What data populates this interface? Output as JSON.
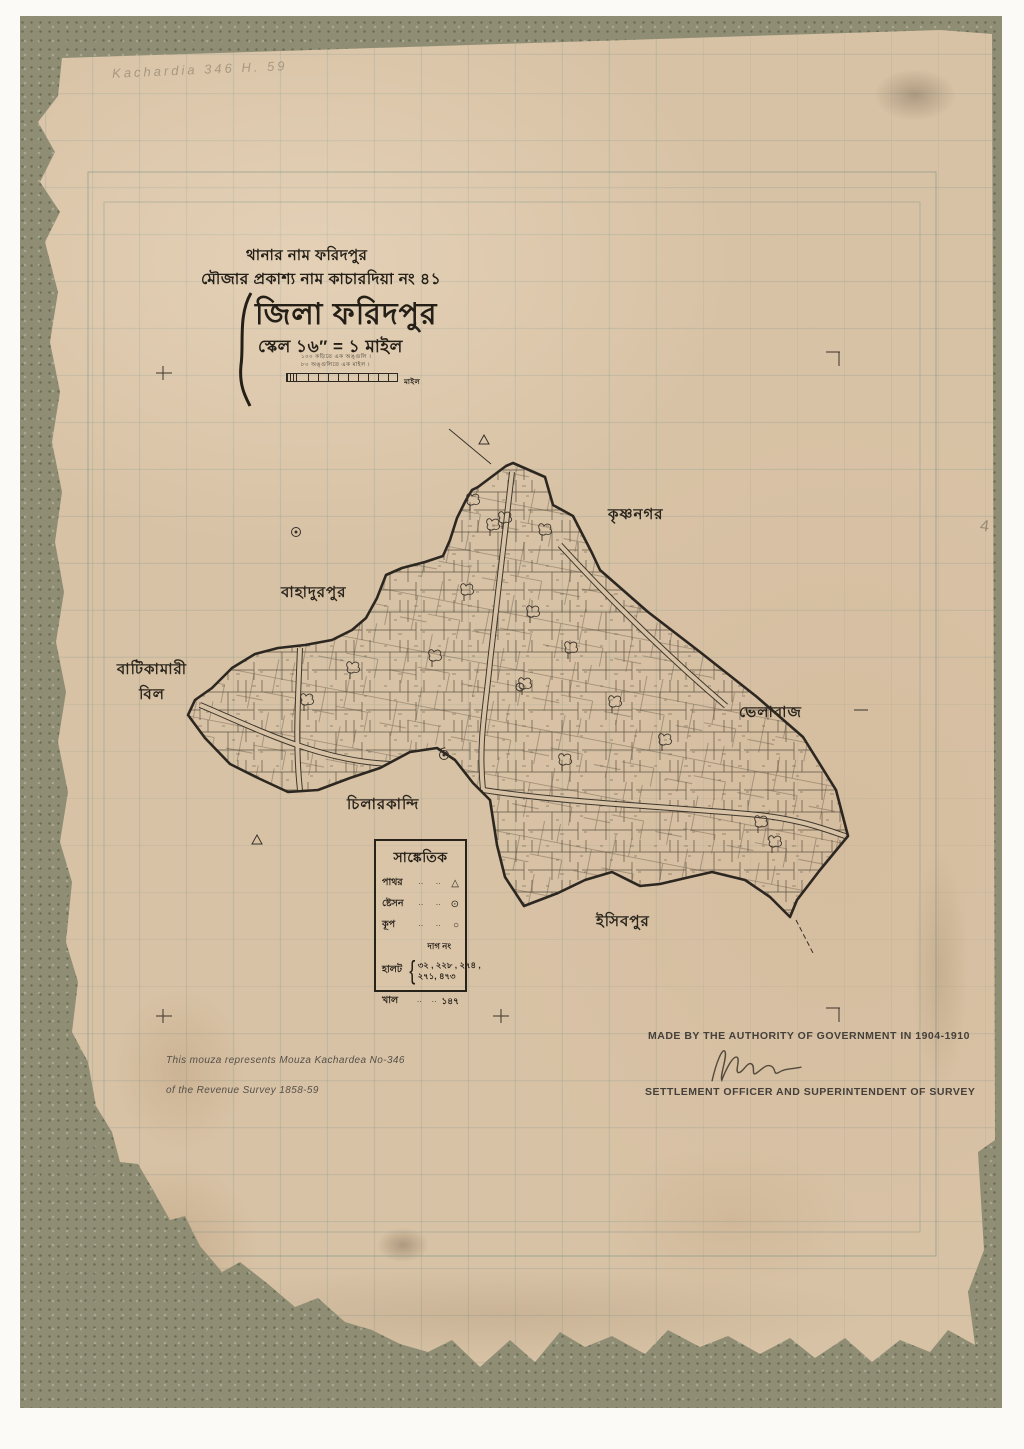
{
  "colors": {
    "paper": "#d8c2a5",
    "backing": "#8f8e75",
    "ink": "#241f17",
    "grid_line": "#688a84",
    "pencil": "#6f665a"
  },
  "title_block": {
    "thana_line": "থানার নাম ফরিদপুর",
    "mouza_line": "মৌজার প্রকাশ্য নাম কাচারদিয়া নং ৪১",
    "district_line": "জিলা ফরিদপুর",
    "scale_line": "স্কেল ১৬″ = ১ মাইল",
    "scale_note_1": "১০০ কড়িতে এক অঙ্গুলি ।",
    "scale_note_2": "৮০ অঙ্গুলিতে এক মাইল ।",
    "scale_unit_label": "মাইল"
  },
  "place_labels": {
    "krishnanagar": "কৃষ্ণনগর",
    "bahadurpur": "বাহাদুরপুর",
    "batikamari_bil": "বাটিকামারী\nবিল",
    "bhelabaj": "ভেলাবাজ",
    "chilarkandi": "চিলারকান্দি",
    "isibpur": "ইসিবপুর"
  },
  "legend": {
    "title": "সাঙ্কেতিক",
    "leader": "··",
    "rows": [
      {
        "label": "পাথর",
        "symbol": "△",
        "symbol_name": "triangle-station"
      },
      {
        "label": "ষ্টেসন",
        "symbol": "⊙",
        "symbol_name": "circle-dot-station"
      },
      {
        "label": "কূপ",
        "symbol": "○",
        "symbol_name": "well-circle"
      }
    ],
    "dag_heading": "দাগ নং",
    "halot_label": "হালট",
    "halot_numbers_line1": "৩২ , ২২৮ , ২৭৪ ,",
    "halot_numbers_line2": "২৭১, ৪৭৩",
    "khal_label": "খাল",
    "khal_number": "১৪৭",
    "brace": "{"
  },
  "footer": {
    "left_line1": "This mouza represents Mouza Kachardea No-346",
    "left_line2": "of the Revenue Survey 1858-59",
    "right_line1": "MADE BY THE AUTHORITY OF GOVERNMENT IN 1904-1910",
    "right_line2": "SETTLEMENT OFFICER AND SUPERINTENDENT OF SURVEY"
  },
  "annotations": {
    "pencil_note": "Kachardia 346 H. 59",
    "pencil_mark": "4"
  }
}
